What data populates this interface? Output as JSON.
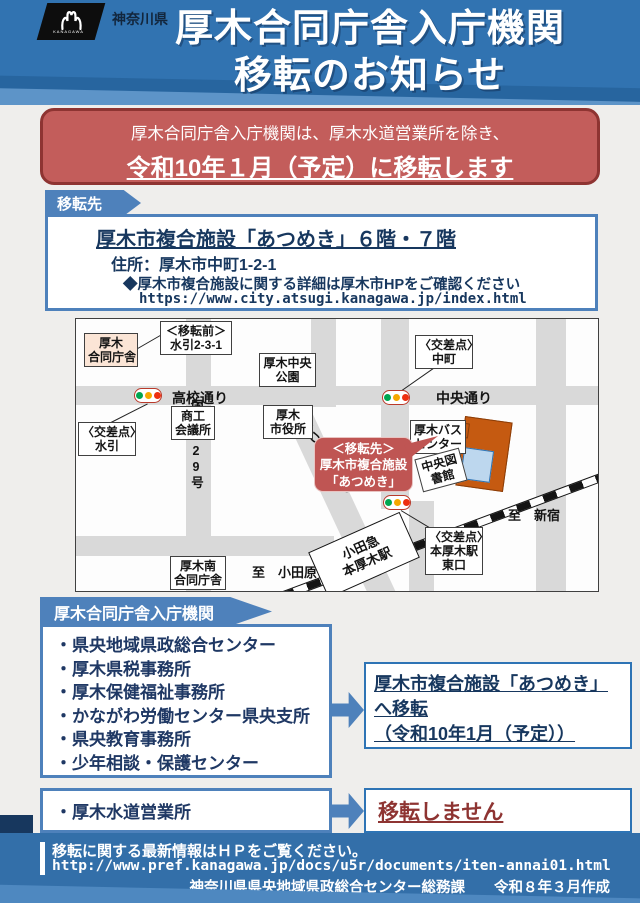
{
  "header": {
    "brand": "神奈川県",
    "logo_text": "KANAGAWA",
    "title_line1": "厚木合同庁舎入庁機関",
    "title_line2": "移転のお知らせ"
  },
  "banner": {
    "line1": "厚木合同庁舎入庁機関は、厚木水道営業所を除き、",
    "line2": "令和10年１月（予定）に移転します"
  },
  "destination": {
    "tag": "移転先",
    "facility": "厚木市複合施設「あつめき」６階・７階",
    "address": "住所：厚木市中町1-2-1",
    "note": "◆厚木市複合施設に関する詳細は厚木市HPをご確認ください",
    "url": "https://www.city.atsugi.kanagawa.jp/index.html"
  },
  "map": {
    "godochosha_l1": "厚木",
    "godochosha_l2": "合同庁舎",
    "before_l1": "＜移転前＞",
    "before_l2": "水引2-3-1",
    "park_l1": "厚木中央",
    "park_l2": "公園",
    "street_koko": "高校通り",
    "street_chuo": "中央通り",
    "street_kokudo": "国道129号",
    "street_odori": "あつぎ大通り",
    "xing_mizuhiki_l1": "〈交差点〉",
    "xing_mizuhiki_l2": "水引",
    "shoko_l1": "商工",
    "shoko_l2": "会議所",
    "cityhall_l1": "厚木",
    "cityhall_l2": "市役所",
    "xing_nakacho_l1": "〈交差点〉",
    "xing_nakacho_l2": "中町",
    "bus_l1": "厚木バス",
    "bus_l2": "センター",
    "callout_l1": "＜移転先＞",
    "callout_l2": "厚木市複合施設",
    "callout_l3": "「あつめき」",
    "library_l1": "中央図",
    "library_l2": "書館",
    "station_l1": "小田急",
    "station_l2": "本厚木駅",
    "xing_east_l1": "〈交差点〉",
    "xing_east_l2": "本厚木駅",
    "xing_east_l3": "東口",
    "to_shinjuku": "至　新宿",
    "to_odawara": "至　小田原",
    "minami_l1": "厚木南",
    "minami_l2": "合同庁舎"
  },
  "agencies": {
    "tag": "厚木合同庁舎入庁機関",
    "items": [
      "・県央地域県政総合センター",
      "・厚木県税事務所",
      "・厚木保健福祉事務所",
      "・かながわ労働センター県央支所",
      "・県央教育事務所",
      "・少年相談・保護センター"
    ]
  },
  "move_to": {
    "line1": "厚木市複合施設「あつめき」へ移転",
    "line2": "（令和10年1月（予定））"
  },
  "water": {
    "item": "・厚木水道営業所",
    "status": "移転しません"
  },
  "footer": {
    "notice": "移転に関する最新情報はＨＰをご覧ください。",
    "url": "http://www.pref.kanagawa.jp/docs/u5r/documents/iten-annai01.html",
    "credit": "神奈川県県央地域県政総合センター総務課　　令和８年３月作成"
  },
  "colors": {
    "header_blue": "#3173b1",
    "banner_red": "#c35d5b",
    "banner_border": "#8e3432",
    "tag_blue": "#4e81bb",
    "navy_text": "#17375e",
    "status_red": "#8e3432",
    "building_orange": "#c55a11",
    "building_blue": "#bdd7ee",
    "street_gray": "#d9d9d9",
    "footer_blue": "#336fa9"
  }
}
